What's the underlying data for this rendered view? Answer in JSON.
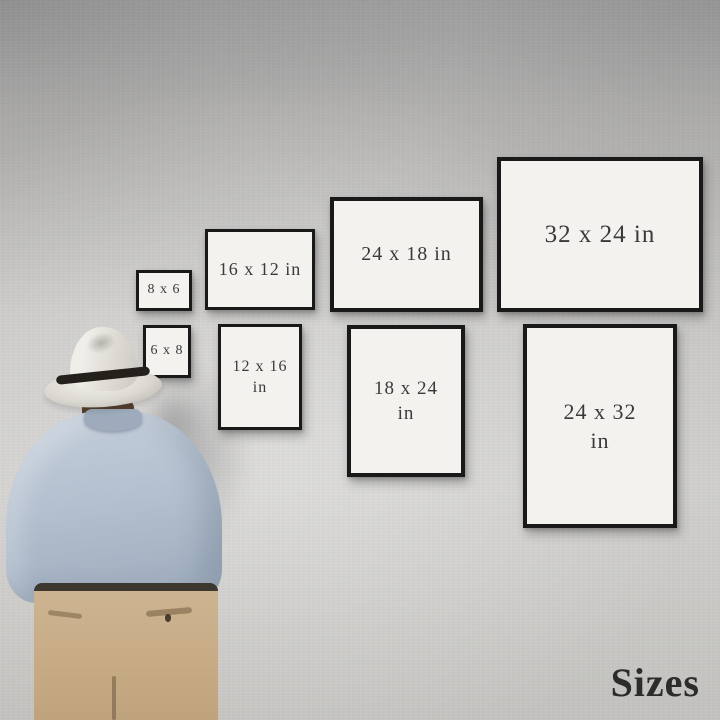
{
  "scene": {
    "caption": "Sizes",
    "colors": {
      "wall": "#c9c8c6",
      "frame_border": "#191919",
      "frame_face": "#f3f2ef",
      "label_text": "#3a3a3a",
      "caption_text": "#2c2c2c",
      "shirt": "#b3c0cf",
      "trousers": "#c8ad88",
      "hat": "#ece9e3",
      "hat_band": "#24201b",
      "hair": "#55412f"
    }
  },
  "frames": [
    {
      "id": "8x6",
      "orientation": "landscape",
      "line1": "8 x 6",
      "line2": ""
    },
    {
      "id": "16x12",
      "orientation": "landscape",
      "line1": "16 x 12 in",
      "line2": ""
    },
    {
      "id": "24x18",
      "orientation": "landscape",
      "line1": "24 x 18 in",
      "line2": ""
    },
    {
      "id": "32x24",
      "orientation": "landscape",
      "line1": "32 x 24 in",
      "line2": ""
    },
    {
      "id": "6x8",
      "orientation": "portrait",
      "line1": "6 x 8",
      "line2": ""
    },
    {
      "id": "12x16",
      "orientation": "portrait",
      "line1": "12 x 16",
      "line2": "in"
    },
    {
      "id": "18x24",
      "orientation": "portrait",
      "line1": "18 x 24",
      "line2": "in"
    },
    {
      "id": "24x32",
      "orientation": "portrait",
      "line1": "24 x 32",
      "line2": "in"
    }
  ]
}
